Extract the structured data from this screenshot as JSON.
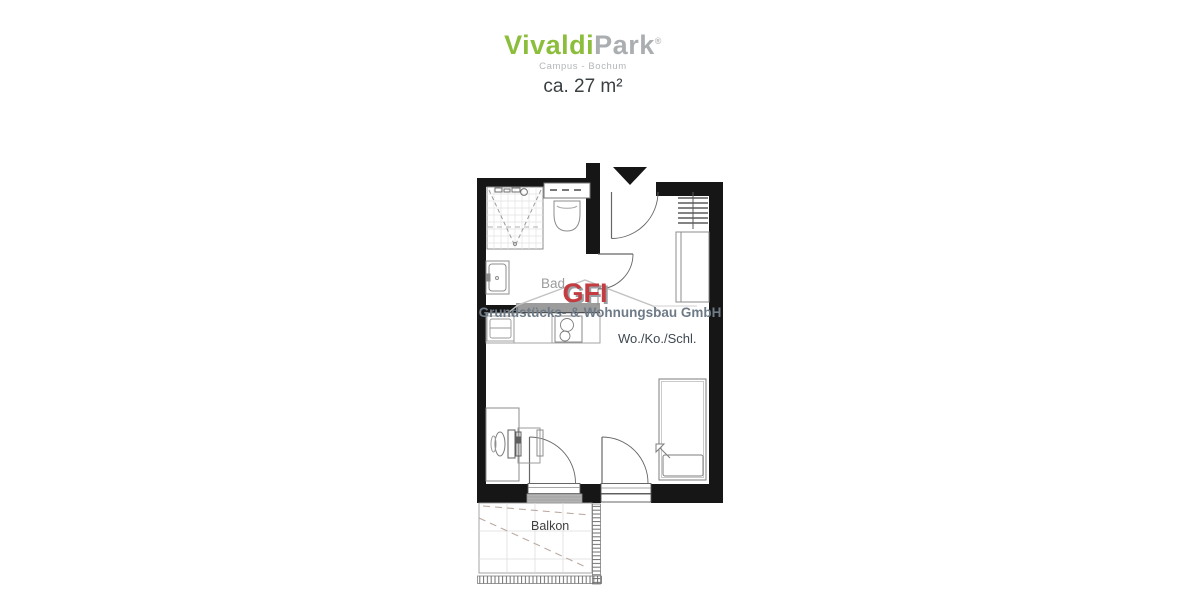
{
  "brand": {
    "name_part1": "Vivaldi",
    "name_part2": "Park",
    "registered_mark": "®",
    "subtitle": "Campus - Bochum",
    "color_primary": "#8cbe3c",
    "color_secondary": "#aaaeb0"
  },
  "area_label": "ca. 27 m²",
  "floorplan": {
    "labels": {
      "bathroom": "Bad",
      "living_room": "Wo./Ko./Schl.",
      "balcony": "Balkon"
    },
    "wall_color": "#161616",
    "fixture_line_color": "#8c8c8c"
  },
  "watermark": {
    "logo_text": "GFI",
    "company_name": "Grundstücks- & Wohnungsbau GmbH",
    "logo_color": "#c43b40",
    "text_color": "#6e7b87",
    "outline_color": "#c2c2c2"
  }
}
